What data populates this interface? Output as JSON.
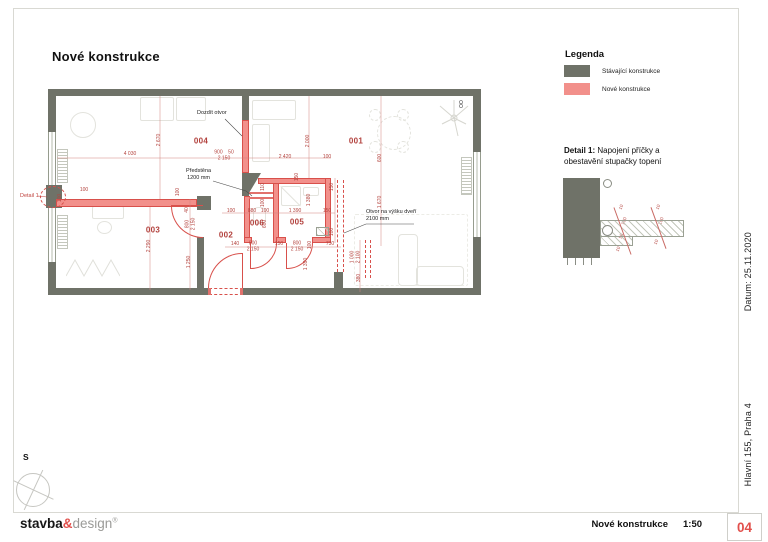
{
  "page": {
    "title": "Nové konstrukce"
  },
  "compass": {
    "label": "S"
  },
  "legend": {
    "heading": "Legenda",
    "items": [
      {
        "label": "Stávající konstrukce",
        "color": "#6f7268"
      },
      {
        "label": "Nové konstrukce",
        "color": "#f2908b"
      }
    ]
  },
  "detail_panel": {
    "heading_bold": "Detail 1:",
    "heading_rest": "Napojení příčky  a obestavění stupačky topení"
  },
  "sidebar": {
    "date": "Datum: 25.11.2020",
    "address": "Hlavní 155, Praha 4"
  },
  "footer": {
    "logo": {
      "part1": "stavba",
      "amp": "&",
      "part2": "design",
      "reg": "®"
    },
    "drawing_title": "Nové konstrukce",
    "scale": "1:50",
    "sheet": "04"
  },
  "plan": {
    "corner_mark": "OO",
    "room_labels": [
      {
        "n": "001",
        "x": 356,
        "y": 141
      },
      {
        "n": "002",
        "x": 226,
        "y": 235
      },
      {
        "n": "003",
        "x": 153,
        "y": 230
      },
      {
        "n": "004",
        "x": 201,
        "y": 141
      },
      {
        "n": "005",
        "x": 297,
        "y": 222
      },
      {
        "n": "006",
        "x": 257,
        "y": 223
      }
    ],
    "annotations": [
      {
        "t": "Dozdít otvor",
        "x": 197,
        "y": 110
      },
      {
        "t": "Předstěna\n1200 mm",
        "x": 186,
        "y": 168,
        "c": 1
      },
      {
        "t": "Otvor na výšku dveří\n2100 mm",
        "x": 366,
        "y": 209
      },
      {
        "t": "Detail 1",
        "x": 20,
        "y": 193,
        "red": 1
      }
    ],
    "dimensions": [
      {
        "t": "4 030",
        "x": 130,
        "y": 155
      },
      {
        "t": "900    50\n2 150",
        "x": 224,
        "y": 156
      },
      {
        "t": "2 420",
        "x": 285,
        "y": 158
      },
      {
        "t": "100",
        "x": 327,
        "y": 158
      },
      {
        "t": "2 670",
        "x": 160,
        "y": 140,
        "r": 1
      },
      {
        "t": "2 000",
        "x": 309,
        "y": 141,
        "r": 1
      },
      {
        "t": "600",
        "x": 381,
        "y": 158,
        "r": 1
      },
      {
        "t": "1 670",
        "x": 381,
        "y": 202,
        "r": 1
      },
      {
        "t": "1 000\n2 100",
        "x": 356,
        "y": 257,
        "r": 1
      },
      {
        "t": "380",
        "x": 360,
        "y": 278,
        "r": 1
      },
      {
        "t": "100",
        "x": 231,
        "y": 212
      },
      {
        "t": "880",
        "x": 252,
        "y": 212
      },
      {
        "t": "100",
        "x": 265,
        "y": 212
      },
      {
        "t": "1 390",
        "x": 295,
        "y": 212
      },
      {
        "t": "150",
        "x": 327,
        "y": 212
      },
      {
        "t": "150",
        "x": 298,
        "y": 177,
        "r": 1
      },
      {
        "t": "110",
        "x": 264,
        "y": 187,
        "r": 1
      },
      {
        "t": "100",
        "x": 264,
        "y": 203,
        "r": 1
      },
      {
        "t": "600",
        "x": 266,
        "y": 224,
        "r": 1
      },
      {
        "t": "150",
        "x": 333,
        "y": 187,
        "r": 1
      },
      {
        "t": "1 380",
        "x": 310,
        "y": 200,
        "r": 1
      },
      {
        "t": "100",
        "x": 333,
        "y": 232,
        "r": 1
      },
      {
        "t": "140",
        "x": 235,
        "y": 245
      },
      {
        "t": "800\n2 150",
        "x": 253,
        "y": 247
      },
      {
        "t": "150",
        "x": 279,
        "y": 245
      },
      {
        "t": "800\n2 150",
        "x": 297,
        "y": 247
      },
      {
        "t": "100",
        "x": 311,
        "y": 245,
        "r": 1
      },
      {
        "t": "730",
        "x": 330,
        "y": 245
      },
      {
        "t": "1 390",
        "x": 307,
        "y": 264,
        "r": 1
      },
      {
        "t": "100",
        "x": 61,
        "y": 198,
        "r": 1
      },
      {
        "t": "100",
        "x": 84,
        "y": 191
      },
      {
        "t": "100",
        "x": 179,
        "y": 192,
        "r": 1
      },
      {
        "t": "40",
        "x": 188,
        "y": 210,
        "r": 1
      },
      {
        "t": "800\n2 150",
        "x": 191,
        "y": 224,
        "r": 1
      },
      {
        "t": "2 290",
        "x": 150,
        "y": 246,
        "r": 1
      },
      {
        "t": "1 250",
        "x": 190,
        "y": 262,
        "r": 1
      },
      {
        "t": "10",
        "x": 621,
        "y": 207,
        "r": 2
      },
      {
        "t": "100",
        "x": 624,
        "y": 221,
        "r": 2
      },
      {
        "t": "50",
        "x": 621,
        "y": 236,
        "r": 2
      },
      {
        "t": "10",
        "x": 618,
        "y": 249,
        "r": 2
      },
      {
        "t": "10",
        "x": 658,
        "y": 207,
        "r": 2
      },
      {
        "t": "100",
        "x": 661,
        "y": 221,
        "r": 2
      },
      {
        "t": "10",
        "x": 656,
        "y": 242,
        "r": 2
      }
    ]
  },
  "colors": {
    "existing": "#6f7268",
    "new_fill": "#f2908b",
    "new_edge": "#d8504b",
    "dim_text": "#b4443f",
    "sheet_number": "#e2504c"
  }
}
